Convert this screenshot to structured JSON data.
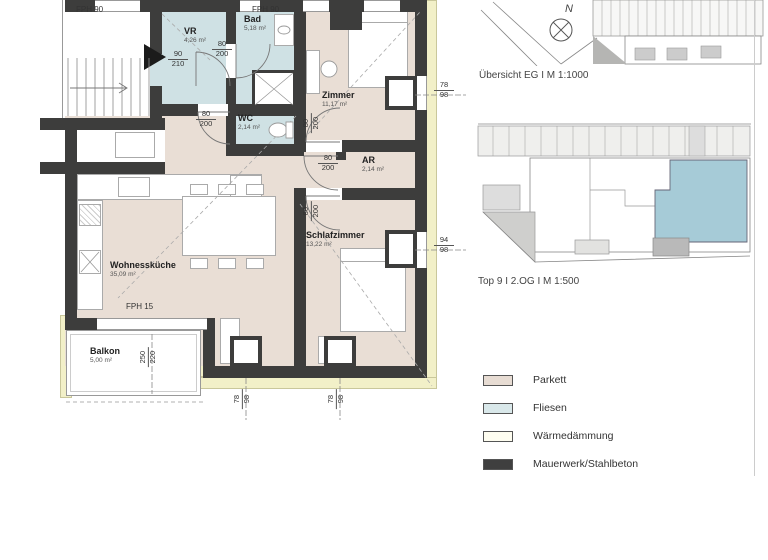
{
  "plan": {
    "fph_labels": [
      "FPH 90",
      "FPH 90",
      "FPH 15"
    ],
    "rooms": [
      {
        "name": "VR",
        "area": "4,26 m²"
      },
      {
        "name": "Bad",
        "area": "5,18 m²"
      },
      {
        "name": "WC",
        "area": "2,14 m²"
      },
      {
        "name": "Zimmer",
        "area": "11,17 m²"
      },
      {
        "name": "AR",
        "area": "2,14 m²"
      },
      {
        "name": "Schlafzimmer",
        "area": "13,22 m²"
      },
      {
        "name": "Wohnessküche",
        "area": "35,09 m²"
      },
      {
        "name": "Balkon",
        "area": "5,00 m²"
      }
    ],
    "dims": {
      "entrance_door": {
        "a": "90",
        "b": "210"
      },
      "bad_door": {
        "a": "80",
        "b": "200"
      },
      "wc_door": {
        "a": "80",
        "b": "200"
      },
      "zimmer_door": {
        "a": "80",
        "b": "200"
      },
      "ar_door": {
        "a": "80",
        "b": "200"
      },
      "schlaf_door": {
        "a": "80",
        "b": "200"
      },
      "zimmer_window": {
        "a": "78",
        "b": "98"
      },
      "schlaf_window": {
        "a": "94",
        "b": "98"
      },
      "south_window_1": {
        "a": "78",
        "b": "98"
      },
      "south_window_2": {
        "a": "78",
        "b": "98"
      },
      "balkon_window": {
        "a": "250",
        "b": "220"
      }
    }
  },
  "overviews": {
    "site_caption": "Übersicht EG I M 1:1000",
    "floor_caption": "Top 9 I 2.OG I M 1:500",
    "north_label": "N"
  },
  "legend": {
    "items": [
      {
        "label": "Parkett",
        "color": "#e7dcd3"
      },
      {
        "label": "Fliesen",
        "color": "#d9e8ea"
      },
      {
        "label": "Wärmedämmung",
        "color": "#fefdf0"
      },
      {
        "label": "Mauerwerk/Stahlbeton",
        "color": "#3f3f3f"
      }
    ]
  },
  "colors": {
    "parkett_floor": "#e9ded5",
    "fliesen_floor": "#cfe1e4",
    "insulation": "#f2f0c8",
    "wall": "#3d3d3c",
    "unit_highlight": "#a6cbd7"
  }
}
